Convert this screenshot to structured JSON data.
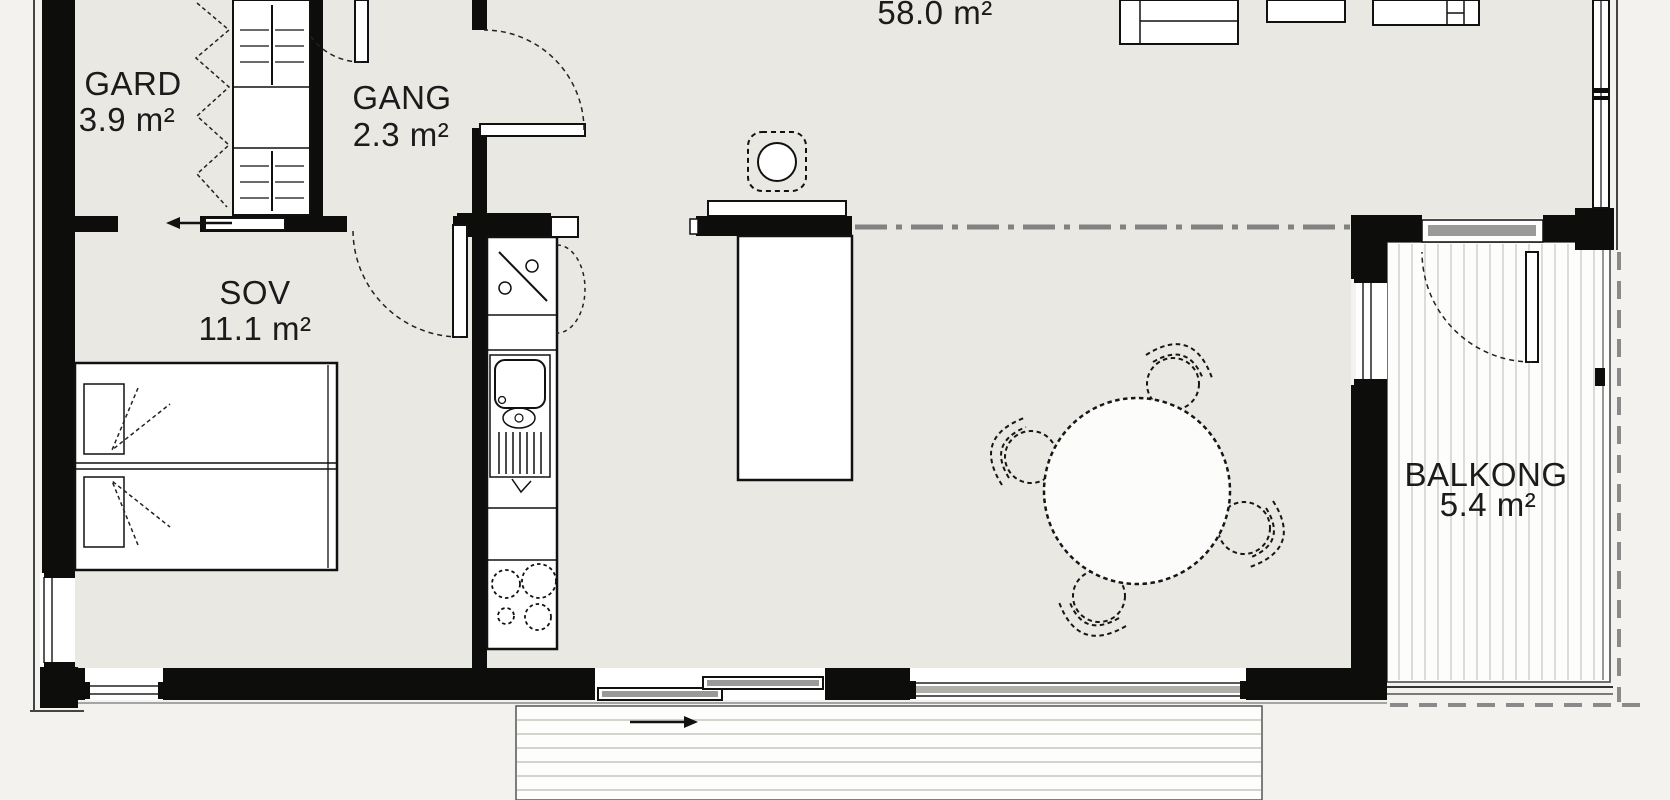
{
  "plan": {
    "type": "apartment-floor-plan",
    "rooms": {
      "gard": {
        "name": "GARD",
        "area": "3.9 m²"
      },
      "gang": {
        "name": "GANG",
        "area": "2.3 m²"
      },
      "sov": {
        "name": "SOV",
        "area": "11.1 m²"
      },
      "living": {
        "area": "58.0 m²"
      },
      "balkong": {
        "name": "BALKONG",
        "area": "5.4 m²"
      }
    },
    "symbols": [
      "wardrobe-icon",
      "double-bed-icon",
      "sliding-door-icon",
      "swing-door-icon",
      "kitchen-counter-icon",
      "fridge-icon",
      "sink-icon",
      "dishwasher-rack-icon",
      "cooktop-icon",
      "kitchen-island-icon",
      "chimney-stove-icon",
      "dining-table-icon",
      "chair-icon",
      "sofa-icon",
      "balcony-deck-icon",
      "terrace-deck-icon",
      "window-icon",
      "direction-arrow-icon"
    ],
    "colors": {
      "background": "#f3f2ee",
      "floor": "#e9e8e2",
      "wall": "#0d0d0c",
      "deck": "#fdfdfb",
      "plank_line": "#c6c5c0",
      "glass_panel": "#9a9a98",
      "dashdot_line": "#828282",
      "overhang_dashed": "#8a8a8a",
      "text": "#1b1b1b"
    }
  }
}
